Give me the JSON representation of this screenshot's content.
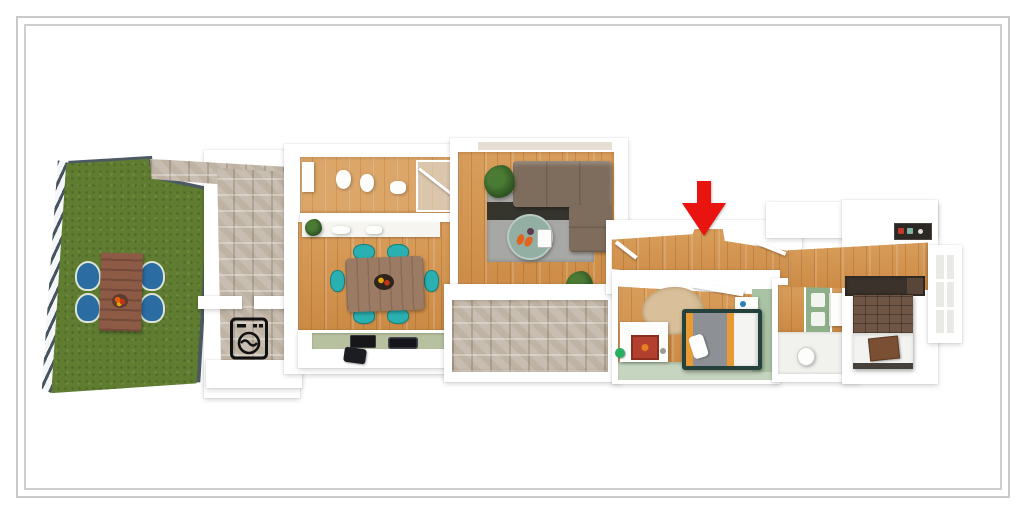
{
  "meta": {
    "description": "Framed 3D top-down dollhouse floor-plan render of a long narrow apartment with a roof garden on the left and bedrooms on the right; a red arrow marks the hallway entrance",
    "visible_text": "none"
  },
  "frame": {
    "outer_border_color": "#c9c9c9",
    "inner_border_color": "#cfcfcf",
    "background": "#ffffff"
  },
  "palette": {
    "wood_floor": "#d2954f",
    "wood_floor_light": "#dca668",
    "grass": "#5f7c31",
    "stone_tile": "#c7bdb0",
    "wall_white": "#ffffff",
    "green_wall": "#aac3a4",
    "railing_hatch_dark": "#46545f",
    "sofa_brown": "#7e6d5d",
    "rug_gray": "#a7a7a5",
    "rug_dark_band": "#35342d",
    "coffee_table_sage": "#93aea3",
    "dining_table": "#9b7b64",
    "dining_chair_teal": "#2ab0b0",
    "garden_table": "#8c5a45",
    "garden_chair_blue": "#2b6ca3",
    "kitchen_counter_sage": "#b7c1a0",
    "appliance_black": "#17171a",
    "bed1_frame": "#24413e",
    "bed1_duvet_gray": "#8d9195",
    "bed1_stripe_orange": "#ea9a33",
    "bed2_headboard_brown": "#6f5544",
    "bed2_linens_white": "#f3f3f1",
    "wardrobe_dark_brown": "#3a322b",
    "rug_beige": "#cdb48d",
    "arrow_red": "#e91310",
    "plant_green": "#2d5322"
  },
  "annotation": {
    "arrow": {
      "shape": "solid down arrow",
      "color": "#e91310",
      "points_at": "hallway entrance between living room and bedrooms"
    }
  },
  "rooms": [
    {
      "id": "garden",
      "name": "Roof terrace garden with lawn, railing and outdoor dining table with 4 blue chairs"
    },
    {
      "id": "entry",
      "name": "Stone-tiled entry hall"
    },
    {
      "id": "laundry",
      "name": "Laundry nook with washing-machine icon"
    },
    {
      "id": "bathroom-1",
      "name": "Bathroom with toilet, bidet, sink and shower"
    },
    {
      "id": "kitchen-dining",
      "name": "Kitchen and dining room with table, 6 teal chairs and counter"
    },
    {
      "id": "living-room",
      "name": "Living room with corner sofa, rug and round coffee table"
    },
    {
      "id": "patio",
      "name": "Stone-tiled patio below the living room"
    },
    {
      "id": "hallway",
      "name": "Hallway marked by the red arrow"
    },
    {
      "id": "bedroom-1",
      "name": "Bedroom with orange-striped duvet bed and dresser"
    },
    {
      "id": "bathroom-2",
      "name": "Second bathroom with green cabinet and toilet"
    },
    {
      "id": "bedroom-2",
      "name": "Bedroom with brown quilted headboard, wardrobe and window"
    }
  ],
  "icons": [
    {
      "name": "washing-machine-icon",
      "style": "black outline pictogram"
    },
    {
      "name": "red-location-arrow-icon",
      "style": "solid red downward arrow"
    }
  ]
}
